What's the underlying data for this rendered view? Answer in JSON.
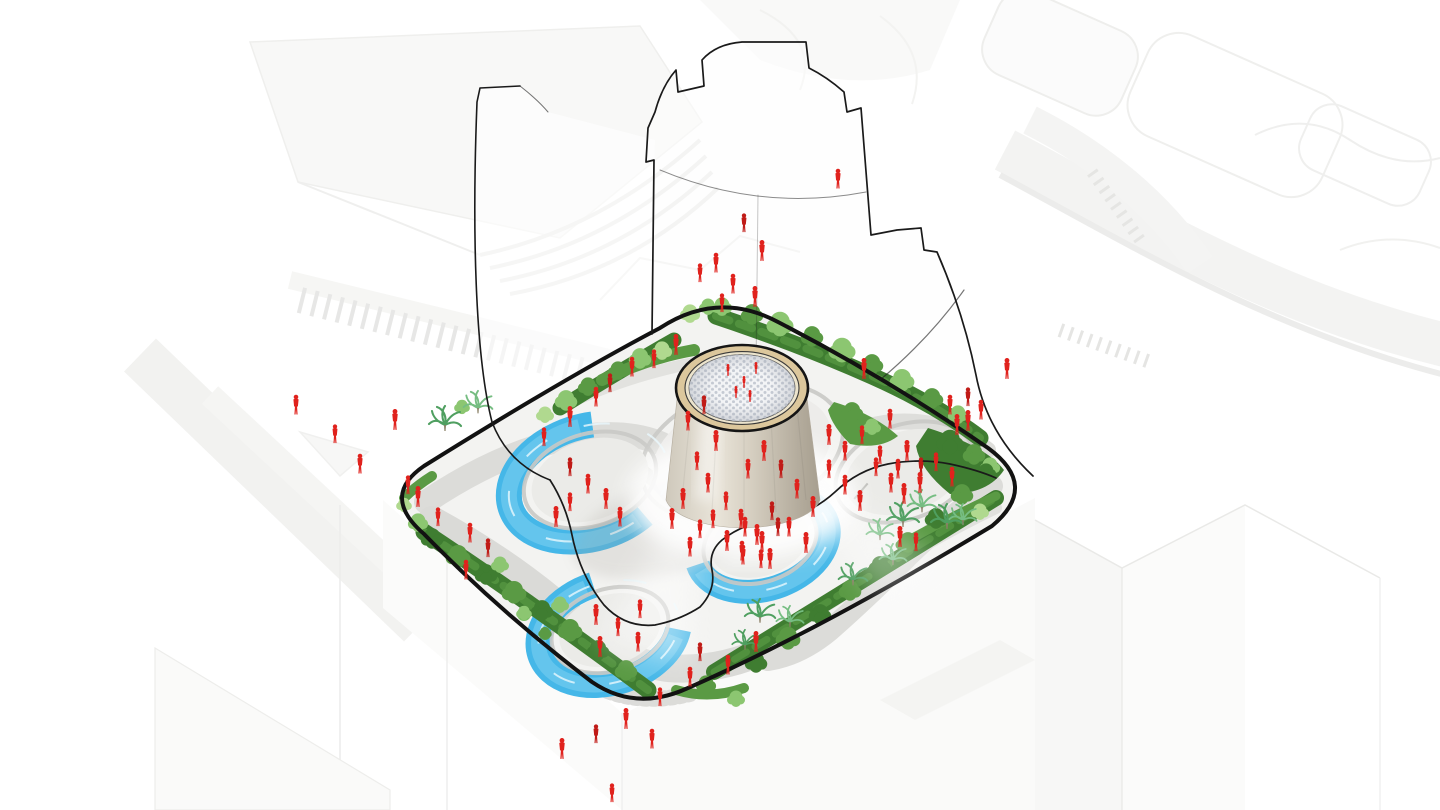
{
  "figure": {
    "kind": "isometric-architectural-site-diagram",
    "background": "#ffffff"
  },
  "palette": {
    "site_ground": "#f3f3f1",
    "site_outline": "#121212",
    "path_gray": "#dbdbd8",
    "path_light": "#e2e2df",
    "hedge_dark": "#3f7d31",
    "hedge_mid": "#5a9a44",
    "tree_light": "#8cc671",
    "tree_pale": "#b0d98f",
    "palm_green": "#4f9f60",
    "palm_light": "#76bd82",
    "water": "#45b7e8",
    "water_light": "#7ed2f0",
    "water_sparkle": "#e8f8fd",
    "plaza_fill": "#ebebe8",
    "plaza_rim": "#c9c9c5",
    "ring_tan": "#dcc79c",
    "tower_light": "#e8e3d8",
    "tower_dark": "#a69e8f",
    "dome_bg": "#f3f4f6",
    "dome_dot": "#c5cad3",
    "person_red": "#e0221d",
    "person_dark": "#c01b17",
    "ghost_line": "#1a1a1a",
    "bg_line": "#e7e7e5"
  },
  "scene": {
    "people": {
      "count": 106,
      "positions": [
        [
          744,
          226
        ],
        [
          716,
          266
        ],
        [
          762,
          254
        ],
        [
          700,
          276
        ],
        [
          733,
          287
        ],
        [
          755,
          300
        ],
        [
          722,
          306
        ],
        [
          838,
          182
        ],
        [
          1007,
          372
        ],
        [
          968,
          400
        ],
        [
          981,
          413
        ],
        [
          957,
          428
        ],
        [
          335,
          437
        ],
        [
          360,
          467
        ],
        [
          395,
          423
        ],
        [
          408,
          488
        ],
        [
          296,
          408
        ],
        [
          626,
          722
        ],
        [
          596,
          737
        ],
        [
          652,
          742
        ],
        [
          562,
          752
        ],
        [
          612,
          796
        ],
        [
          728,
          372,
          0.6
        ],
        [
          744,
          384,
          0.6
        ],
        [
          756,
          370,
          0.6
        ],
        [
          736,
          394,
          0.6
        ],
        [
          750,
          398,
          0.6
        ],
        [
          704,
          408
        ],
        [
          688,
          424
        ],
        [
          716,
          444
        ],
        [
          697,
          464
        ],
        [
          708,
          486
        ],
        [
          683,
          502
        ],
        [
          726,
          504
        ],
        [
          741,
          522
        ],
        [
          757,
          538
        ],
        [
          772,
          514
        ],
        [
          789,
          530
        ],
        [
          806,
          546
        ],
        [
          761,
          562
        ],
        [
          743,
          558
        ],
        [
          727,
          544
        ],
        [
          713,
          522
        ],
        [
          748,
          472
        ],
        [
          764,
          454
        ],
        [
          781,
          472
        ],
        [
          797,
          492
        ],
        [
          813,
          510
        ],
        [
          829,
          472
        ],
        [
          845,
          488
        ],
        [
          860,
          504
        ],
        [
          876,
          470
        ],
        [
          891,
          486
        ],
        [
          907,
          454
        ],
        [
          921,
          470
        ],
        [
          845,
          454
        ],
        [
          829,
          438
        ],
        [
          862,
          438
        ],
        [
          890,
          422
        ],
        [
          864,
          372
        ],
        [
          700,
          532
        ],
        [
          690,
          550
        ],
        [
          672,
          522
        ],
        [
          570,
          470
        ],
        [
          588,
          487
        ],
        [
          606,
          502
        ],
        [
          570,
          505
        ],
        [
          620,
          520
        ],
        [
          556,
          520
        ],
        [
          438,
          520
        ],
        [
          470,
          536
        ],
        [
          418,
          500
        ],
        [
          488,
          551
        ],
        [
          466,
          573
        ],
        [
          596,
          618
        ],
        [
          618,
          630
        ],
        [
          638,
          645
        ],
        [
          600,
          650
        ],
        [
          640,
          612
        ],
        [
          745,
          530
        ],
        [
          762,
          545
        ],
        [
          778,
          530
        ],
        [
          742,
          554
        ],
        [
          770,
          562
        ],
        [
          880,
          458
        ],
        [
          898,
          472
        ],
        [
          920,
          486
        ],
        [
          936,
          465
        ],
        [
          952,
          480
        ],
        [
          904,
          497
        ],
        [
          610,
          386
        ],
        [
          596,
          400
        ],
        [
          570,
          420
        ],
        [
          544,
          440
        ],
        [
          632,
          370
        ],
        [
          676,
          348
        ],
        [
          654,
          362
        ],
        [
          950,
          408
        ],
        [
          968,
          424
        ],
        [
          700,
          655
        ],
        [
          728,
          668
        ],
        [
          756,
          645
        ],
        [
          660,
          700
        ],
        [
          690,
          680
        ],
        [
          900,
          540
        ],
        [
          916,
          545
        ]
      ]
    },
    "trees": {
      "round": [
        [
          752,
          316,
          10,
          1
        ],
        [
          780,
          326,
          12,
          2
        ],
        [
          812,
          338,
          10,
          1
        ],
        [
          842,
          352,
          12,
          2
        ],
        [
          872,
          366,
          10,
          1
        ],
        [
          902,
          382,
          11,
          2
        ],
        [
          932,
          400,
          10,
          1
        ],
        [
          958,
          416,
          9,
          2
        ],
        [
          722,
          308,
          9,
          2
        ],
        [
          640,
          360,
          10,
          2
        ],
        [
          662,
          352,
          9,
          3
        ],
        [
          618,
          372,
          9,
          1
        ],
        [
          588,
          388,
          9,
          1
        ],
        [
          566,
          402,
          10,
          2
        ],
        [
          545,
          416,
          8,
          3
        ],
        [
          690,
          315,
          9,
          3
        ],
        [
          708,
          308,
          8,
          2
        ],
        [
          950,
          444,
          12,
          0
        ],
        [
          974,
          456,
          10,
          1
        ],
        [
          990,
          468,
          9,
          2
        ],
        [
          852,
          414,
          10,
          1
        ],
        [
          872,
          428,
          8,
          2
        ],
        [
          418,
          524,
          9,
          2
        ],
        [
          404,
          506,
          7,
          3
        ],
        [
          462,
          408,
          7,
          2
        ],
        [
          432,
          540,
          10,
          0
        ],
        [
          458,
          558,
          11,
          1
        ],
        [
          486,
          576,
          10,
          0
        ],
        [
          514,
          594,
          11,
          1
        ],
        [
          542,
          612,
          10,
          0
        ],
        [
          570,
          632,
          11,
          1
        ],
        [
          598,
          652,
          10,
          0
        ],
        [
          626,
          672,
          10,
          1
        ],
        [
          500,
          566,
          8,
          2
        ],
        [
          560,
          606,
          8,
          2
        ],
        [
          706,
          686,
          9,
          1
        ],
        [
          756,
          664,
          10,
          0
        ],
        [
          788,
          640,
          11,
          1
        ],
        [
          820,
          616,
          10,
          0
        ],
        [
          850,
          592,
          10,
          1
        ],
        [
          880,
          568,
          10,
          0
        ],
        [
          908,
          544,
          10,
          1
        ],
        [
          936,
          520,
          10,
          0
        ],
        [
          962,
          496,
          10,
          1
        ],
        [
          986,
          474,
          9,
          0
        ],
        [
          524,
          614,
          7,
          2
        ],
        [
          545,
          634,
          6,
          1
        ],
        [
          980,
          513,
          8,
          3
        ],
        [
          736,
          700,
          8,
          2
        ]
      ],
      "palms": [
        [
          445,
          425,
          1
        ],
        [
          478,
          408,
          0.9
        ],
        [
          903,
          521,
          1
        ],
        [
          922,
          507,
          0.9
        ],
        [
          947,
          523,
          1
        ],
        [
          963,
          520,
          0.85
        ],
        [
          760,
          617,
          0.95
        ],
        [
          790,
          622,
          0.85
        ],
        [
          745,
          645,
          0.8
        ],
        [
          880,
          535,
          0.85
        ],
        [
          853,
          580,
          0.9
        ],
        [
          893,
          560,
          0.85
        ]
      ]
    },
    "features": {
      "pools": 3,
      "circular_plazas": 5,
      "central_pavilion": 1,
      "ghost_tower_outline": 1
    }
  }
}
